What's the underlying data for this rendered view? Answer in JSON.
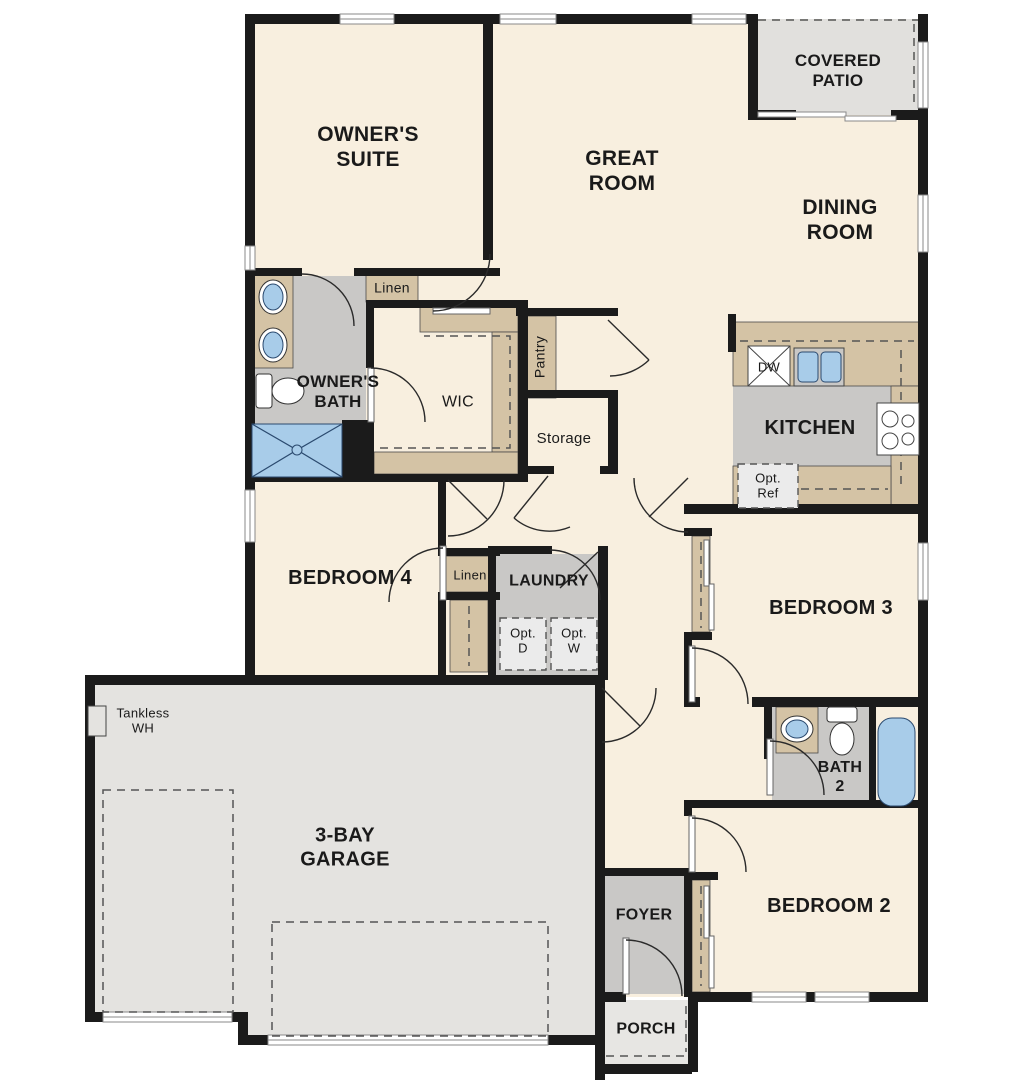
{
  "plan": {
    "rooms": {
      "owners_suite": "OWNER'S\nSUITE",
      "great_room": "GREAT\nROOM",
      "covered_patio": "COVERED\nPATIO",
      "dining_room": "DINING\nROOM",
      "owners_bath": "OWNER'S\nBATH",
      "linen_upper": "Linen",
      "wic": "WIC",
      "pantry": "Pantry",
      "storage": "Storage",
      "kitchen": "KITCHEN",
      "bedroom4": "BEDROOM 4",
      "linen_hall": "Linen",
      "laundry": "LAUNDRY",
      "bedroom3": "BEDROOM 3",
      "garage": "3-BAY\nGARAGE",
      "bath2": "BATH\n2",
      "bedroom2": "BEDROOM 2",
      "foyer": "FOYER",
      "porch": "PORCH"
    },
    "fixtures": {
      "dishwasher": "DW",
      "opt_ref": "Opt.\nRef",
      "opt_dryer": "Opt.\nD",
      "opt_washer": "Opt.\nW",
      "tankless_wh": "Tankless\nWH"
    },
    "colors": {
      "wall": "#1b1b1b",
      "floor": "#f8efdf",
      "wet_floor": "#c9c8c6",
      "garage_floor": "#e4e3e0",
      "patio_floor": "#e1e0dd",
      "porch_floor": "#e7e6e3",
      "counter": "#d4c3a5",
      "fixture_blue": "#a8cce9"
    }
  }
}
